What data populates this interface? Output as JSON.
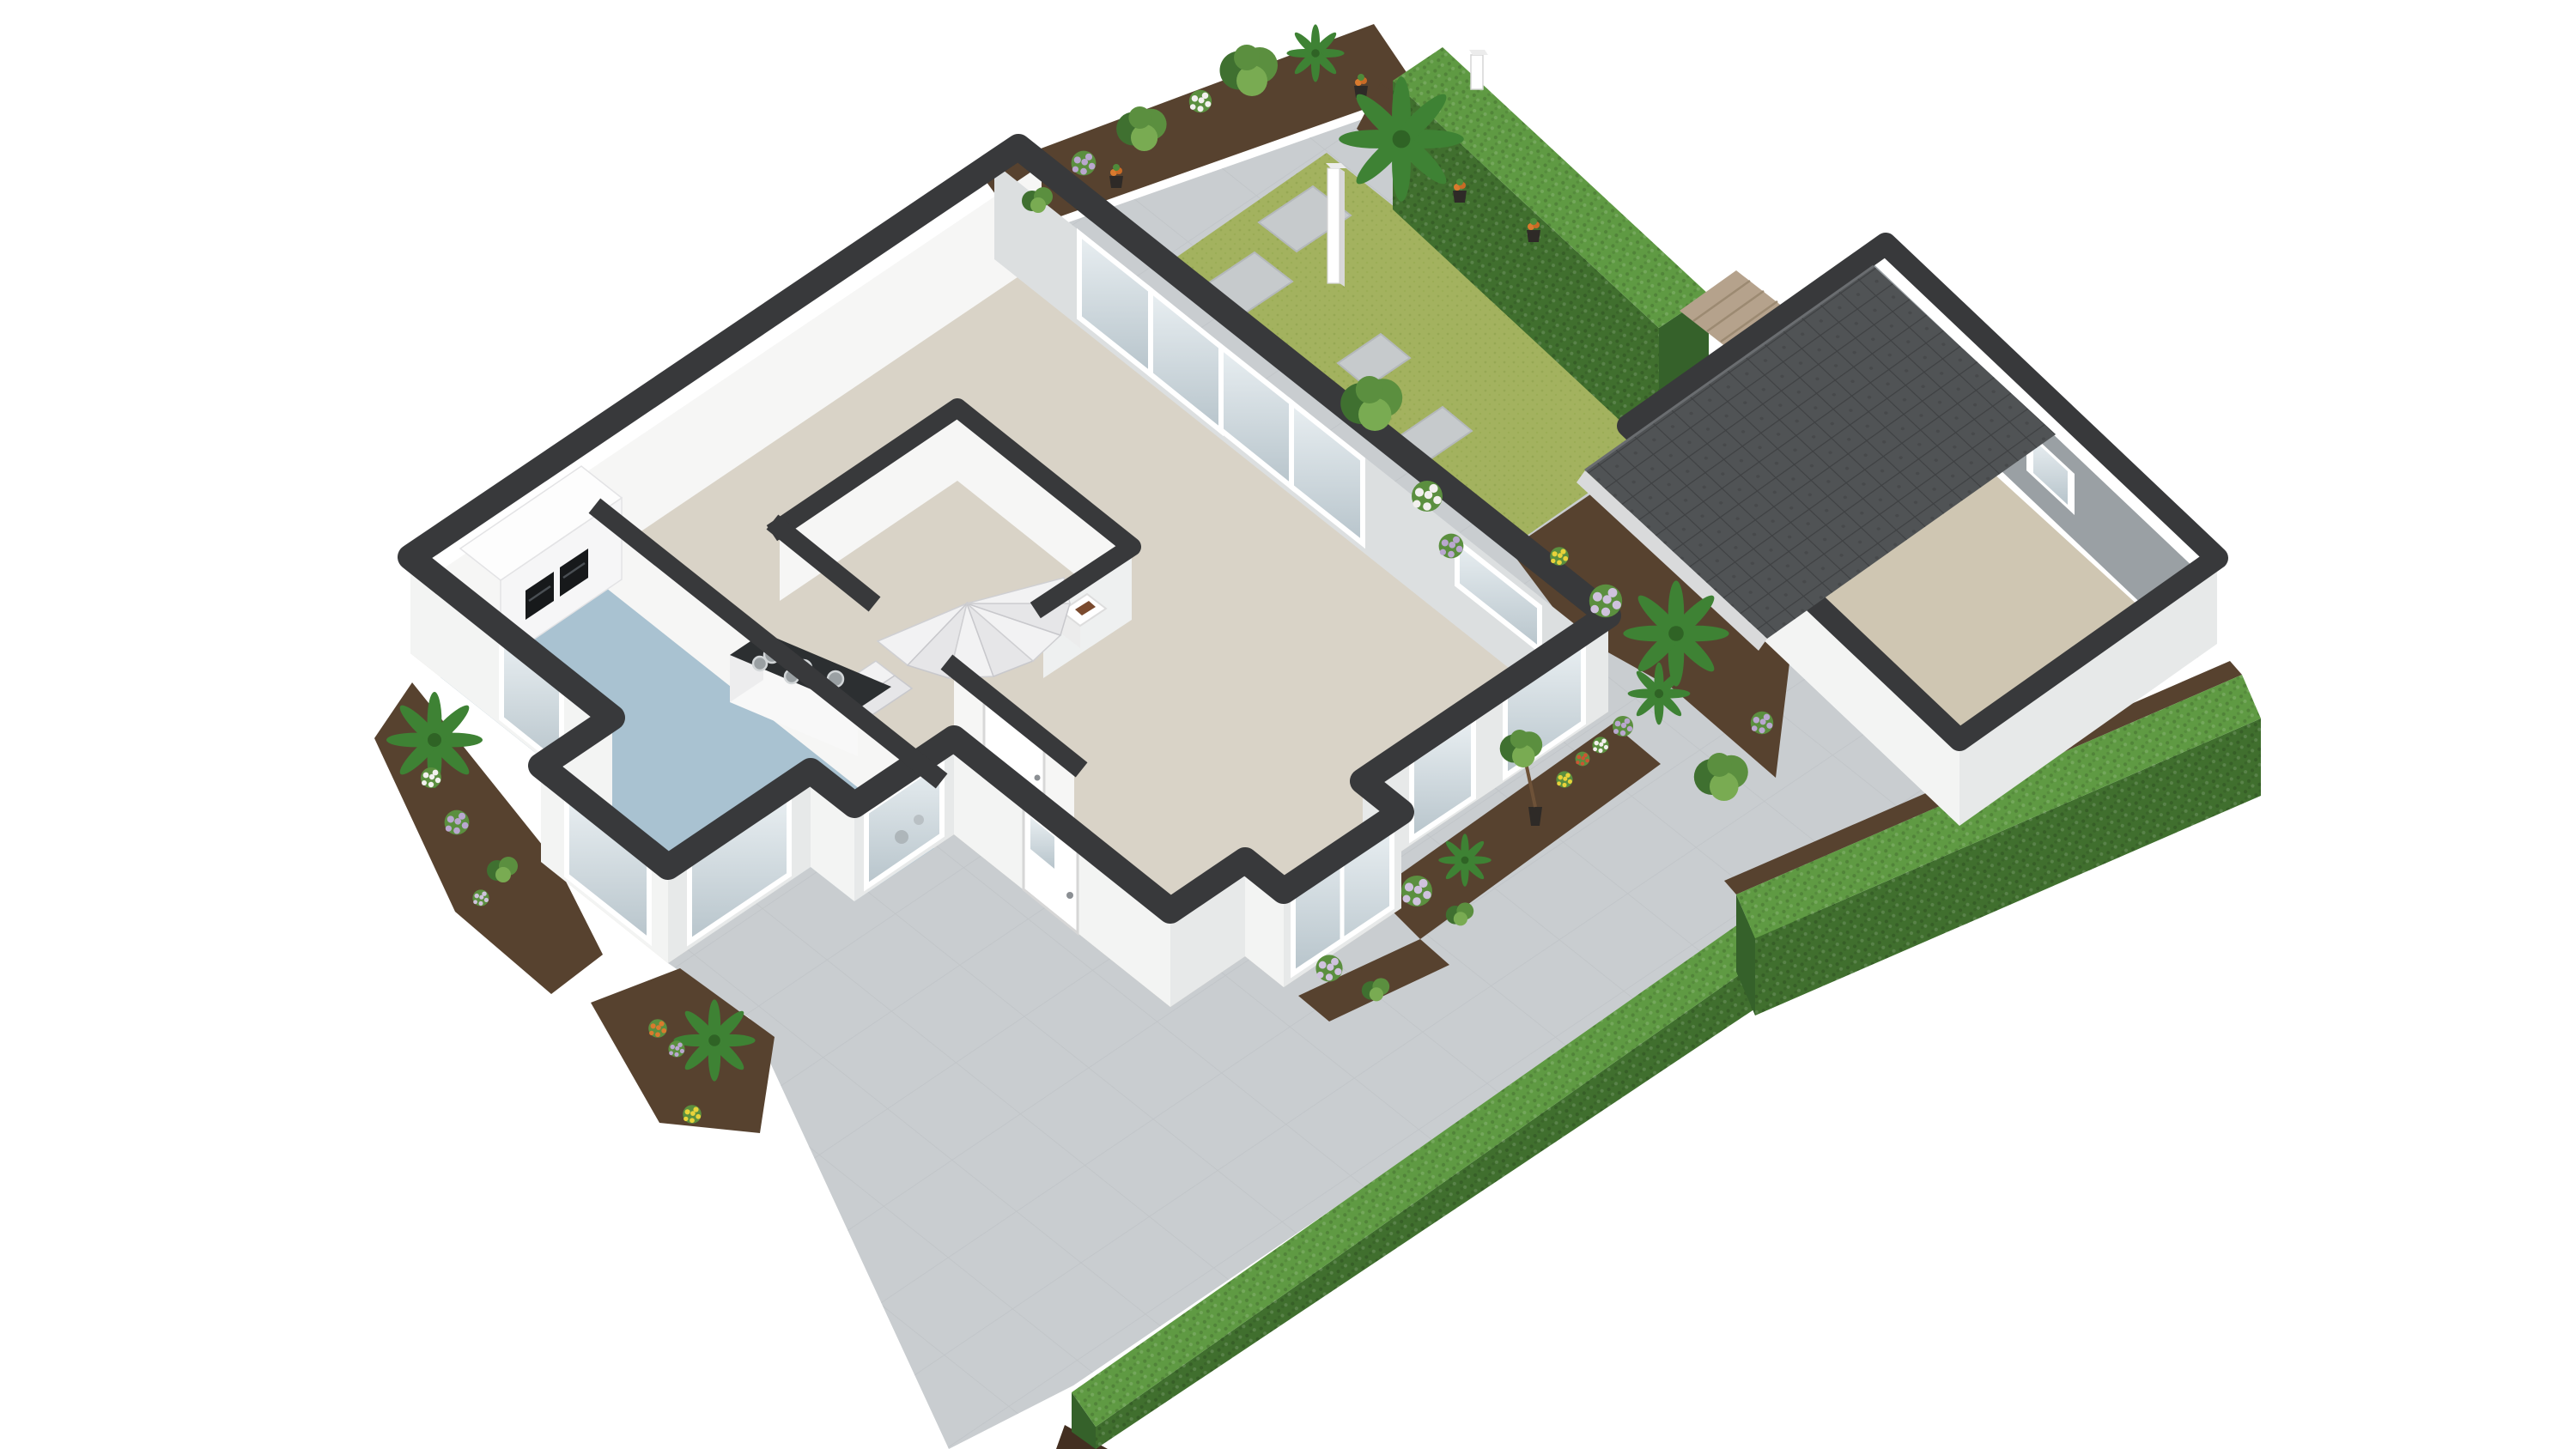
{
  "app": {
    "name": "3D isometric floor plan render",
    "view": "ground floor cutaway, white background"
  },
  "colors": {
    "paving": "#c9cdd0",
    "paving_line": "#b9bdc0",
    "lawn": "#a3b25f",
    "lawn_dot": "#8ea24c",
    "soil": "#57422f",
    "soil_dark": "#432f21",
    "hedge_top": "#5f9a43",
    "hedge_side": "#406f2e",
    "hedge_end": "#35612a",
    "leaf": "#5b8f3f",
    "leaf_dark": "#3f7030",
    "leaf_light": "#79ab52",
    "palm": "#3e8234",
    "flower_purple": "#b9a7cf",
    "flower_white": "#f2f0ee",
    "flower_yellow": "#e8d23a",
    "flower_red": "#cc5533",
    "flower_orange": "#d97a2e",
    "pot": "#2e2a27",
    "wood": "#b5a28c",
    "wall_top": "#38393b",
    "wall_white": "#f3f4f3",
    "wall_shade": "#e7e9e9",
    "wall_inner": "#f6f6f5",
    "wall_gray": "#dcdfe0",
    "garage_inner": "#9aa0a4",
    "floor_living": "#d9d3c7",
    "floor_kitchen": "#a9c2d1",
    "floor_garage": "#cfc6b2",
    "roof": "#505355",
    "roof_line": "#3c3e40",
    "eave": "#d9dadb",
    "glass_hi": "#e9eff2",
    "glass_lo": "#b7c4cb",
    "counter": "#2c2f31",
    "appliance": "#17191b",
    "stair": "#f2f2f3",
    "stair_alt": "#e6e6e8",
    "stone": "#c6cacc",
    "door_handle": "#8b8f93",
    "white": "#ffffff"
  },
  "scene": {
    "background": "#ffffff",
    "buildings": [
      {
        "name": "main-house",
        "wall_cut_color_key": "wall_top",
        "rooms": [
          {
            "name": "kitchen",
            "floor_color_key": "floor_kitchen",
            "features": [
              "tall-cabinet-run-with-two-built-in-ovens",
              "counter-with-hob",
              "bay-window",
              "sink-window"
            ]
          },
          {
            "name": "hallway",
            "floor_color_key": "floor_living",
            "features": [
              "winder-staircase",
              "wc-with-washbasin",
              "closet-door",
              "front-door"
            ]
          },
          {
            "name": "living-room",
            "floor_color_key": "floor_living",
            "features": [
              "four-panel-sliding-glass-door",
              "bay-window",
              "side-windows"
            ]
          }
        ],
        "doors": [
          "front-door",
          "closet-door"
        ],
        "windows": [
          "west-tall-window",
          "kitchen-bay-sw",
          "kitchen-bay-se",
          "kitchen-sink-window",
          "living-bay-window",
          "living-se-window-1",
          "living-se-window-2",
          "garden-side-window"
        ]
      },
      {
        "name": "garage",
        "floor_color_key": "floor_garage",
        "features": [
          "dark-tiled-pitched-roof",
          "side-door-to-passage",
          "small-inner-window"
        ],
        "roof_color_key": "roof"
      }
    ],
    "garden": {
      "lawn": {
        "stepping_stones": 4
      },
      "patio": true,
      "driveway": true,
      "hedges": [
        {
          "name": "tall-back-hedge",
          "position": "top"
        },
        {
          "name": "side-hedge",
          "position": "right-of-garage"
        },
        {
          "name": "front-hedge",
          "position": "bottom-along-driveway"
        }
      ],
      "lamp_posts": 2,
      "wood-deck-strip": 1,
      "flower_beds": 6
    },
    "plants": [
      {
        "type": "shrub"
      },
      {
        "type": "purple-flower-bush"
      },
      {
        "type": "tree"
      },
      {
        "type": "white-flower-bush"
      },
      {
        "type": "large-tree"
      },
      {
        "type": "fan-palm"
      },
      {
        "type": "potted-plant",
        "count": 5
      },
      {
        "type": "lawn-tree"
      },
      {
        "type": "hydrangea-white"
      },
      {
        "type": "hydrangea-purple",
        "count": 4
      },
      {
        "type": "palm",
        "count": 5
      },
      {
        "type": "yellow-flowers",
        "count": 3
      },
      {
        "type": "red-flowers"
      },
      {
        "type": "orange-flowers"
      },
      {
        "type": "potted-tree",
        "count": 2
      }
    ],
    "counts": {
      "sliding_door_panels": 4,
      "ovens": 2,
      "hob_burners": 6
    }
  }
}
